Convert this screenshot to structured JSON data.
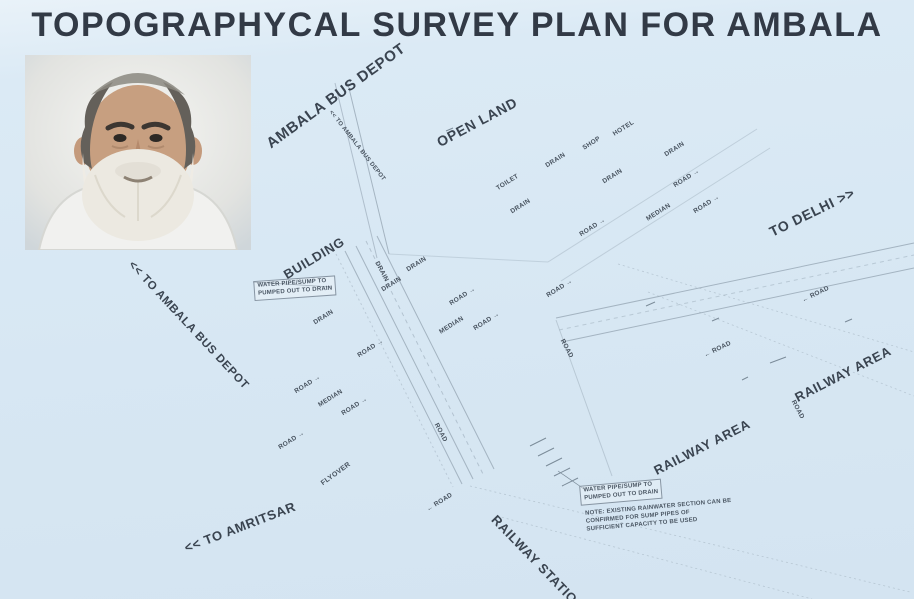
{
  "title": "TOPOGRAPHYCAL SURVEY PLAN FOR AMBALA",
  "photo": {
    "name": "portrait-photo",
    "description": "elderly man with white beard in white shirt"
  },
  "colors": {
    "background": "#d7e7f3",
    "title_ink": "#323a46",
    "label_ink": "#3a4450",
    "line": "#93a3b1"
  },
  "map": {
    "labels": [
      {
        "t": "AMBALA BUS DEPOT",
        "x": 336,
        "y": 96,
        "r": -36,
        "s": 15,
        "big": true
      },
      {
        "t": "OPEN LAND",
        "x": 477,
        "y": 122,
        "r": -28,
        "s": 14,
        "big": true
      },
      {
        "t": "TO DELHI >>",
        "x": 812,
        "y": 212,
        "r": -26,
        "s": 14,
        "big": true
      },
      {
        "t": "BUILDING",
        "x": 314,
        "y": 258,
        "r": -31,
        "s": 13,
        "big": true
      },
      {
        "t": "<< TO AMBALA BUS DEPOT",
        "x": 188,
        "y": 326,
        "r": 47,
        "s": 11.5,
        "big": true
      },
      {
        "t": "<< TO AMRITSAR",
        "x": 240,
        "y": 527,
        "r": -21,
        "s": 13,
        "big": true
      },
      {
        "t": "RAILWAY STATION",
        "x": 538,
        "y": 563,
        "r": 46,
        "s": 13,
        "big": true
      },
      {
        "t": "RAILWAY AREA",
        "x": 702,
        "y": 447,
        "r": -27,
        "s": 13,
        "big": true
      },
      {
        "t": "RAILWAY AREA",
        "x": 843,
        "y": 374,
        "r": -27,
        "s": 13,
        "big": true
      },
      {
        "t": "<< TO AMBALA BUS DEPOT",
        "x": 357,
        "y": 146,
        "r": 52,
        "s": 6
      },
      {
        "t": "TOILET",
        "x": 508,
        "y": 183,
        "r": -32
      },
      {
        "t": "DRAIN",
        "x": 521,
        "y": 207,
        "r": -32
      },
      {
        "t": "DRAIN",
        "x": 556,
        "y": 161,
        "r": -32
      },
      {
        "t": "SHOP",
        "x": 592,
        "y": 144,
        "r": -32
      },
      {
        "t": "HOTEL",
        "x": 624,
        "y": 129,
        "r": -32
      },
      {
        "t": "DRAIN",
        "x": 613,
        "y": 177,
        "r": -32
      },
      {
        "t": "DRAIN",
        "x": 675,
        "y": 150,
        "r": -32
      },
      {
        "t": "ROAD →",
        "x": 687,
        "y": 179,
        "r": -32
      },
      {
        "t": "MEDIAN",
        "x": 659,
        "y": 213,
        "r": -32
      },
      {
        "t": "ROAD →",
        "x": 707,
        "y": 205,
        "r": -32
      },
      {
        "t": "ROAD →",
        "x": 593,
        "y": 228,
        "r": -32
      },
      {
        "t": "DRAIN",
        "x": 417,
        "y": 265,
        "r": -32
      },
      {
        "t": "DRAIN",
        "x": 381,
        "y": 272,
        "r": 62
      },
      {
        "t": "DRAIN",
        "x": 392,
        "y": 285,
        "r": -32
      },
      {
        "t": "DRAIN",
        "x": 324,
        "y": 318,
        "r": -32
      },
      {
        "t": "ROAD →",
        "x": 463,
        "y": 297,
        "r": -32
      },
      {
        "t": "ROAD →",
        "x": 560,
        "y": 289,
        "r": -32
      },
      {
        "t": "MEDIAN",
        "x": 452,
        "y": 326,
        "r": -32
      },
      {
        "t": "ROAD →",
        "x": 487,
        "y": 322,
        "r": -32
      },
      {
        "t": "ROAD →",
        "x": 371,
        "y": 349,
        "r": -32
      },
      {
        "t": "ROAD",
        "x": 566,
        "y": 349,
        "r": 62
      },
      {
        "t": "ROAD →",
        "x": 308,
        "y": 385,
        "r": -32
      },
      {
        "t": "MEDIAN",
        "x": 331,
        "y": 399,
        "r": -32
      },
      {
        "t": "ROAD →",
        "x": 355,
        "y": 407,
        "r": -32
      },
      {
        "t": "ROAD →",
        "x": 292,
        "y": 441,
        "r": -32
      },
      {
        "t": "ROAD",
        "x": 440,
        "y": 433,
        "r": 62
      },
      {
        "t": "← ROAD",
        "x": 440,
        "y": 503,
        "r": -32
      },
      {
        "t": "FLYOVER",
        "x": 336,
        "y": 474,
        "r": -36,
        "s": 7
      },
      {
        "t": "← ROAD",
        "x": 816,
        "y": 295,
        "r": -26
      },
      {
        "t": "← ROAD",
        "x": 718,
        "y": 350,
        "r": -26
      },
      {
        "t": "ROAD",
        "x": 797,
        "y": 410,
        "r": 62
      }
    ],
    "notes": [
      {
        "text": "WATER PIPE/SUMP TO\nPUMPED OUT TO DRAIN",
        "x": 295,
        "y": 288,
        "r": -4,
        "boxed": true
      },
      {
        "text": "WATER PIPE/SUMP TO\nPUMPED OUT TO DRAIN",
        "x": 621,
        "y": 492,
        "r": -5,
        "boxed": true
      },
      {
        "text": "NOTE: EXISTING RAINWATER SECTION CAN BE\nCONFIRMED FOR SUMP PIPES OF\nSUFFICIENT CAPACITY TO BE USED",
        "x": 659,
        "y": 516,
        "r": -5,
        "boxed": false
      }
    ]
  }
}
